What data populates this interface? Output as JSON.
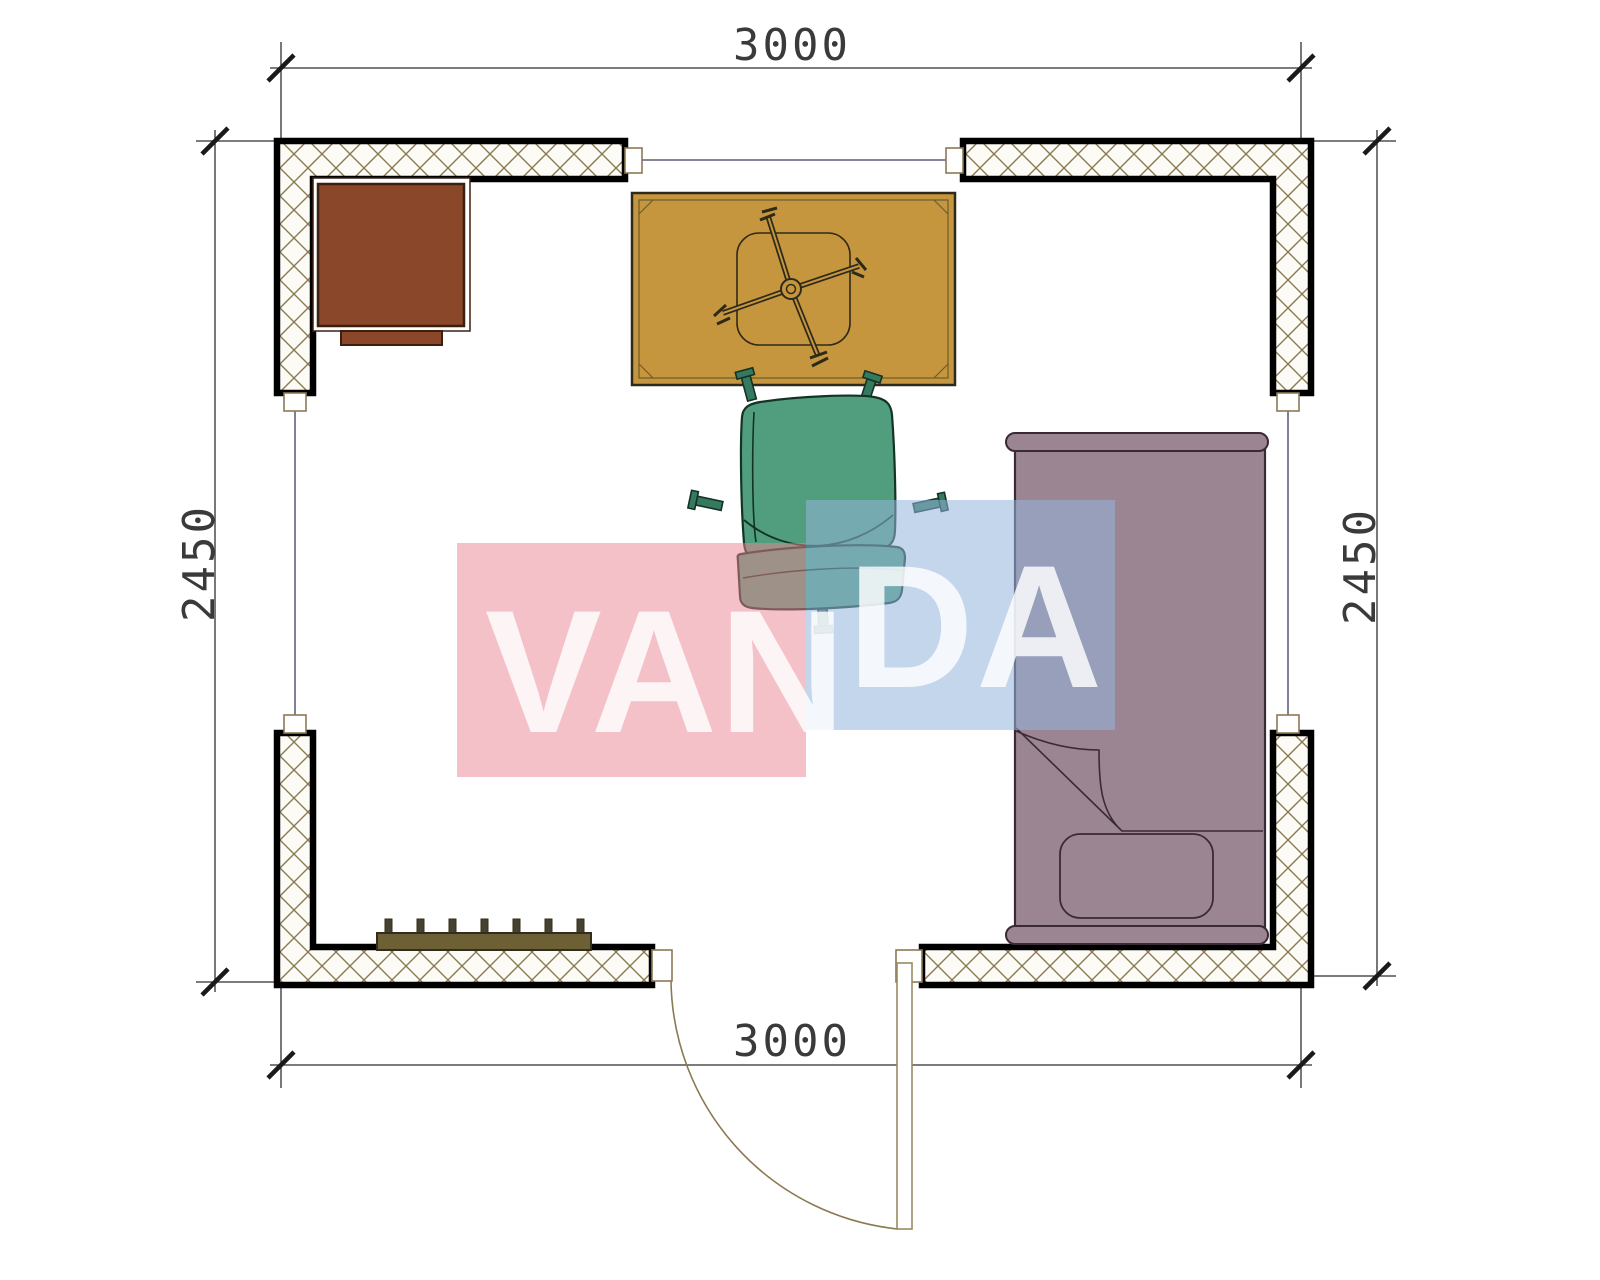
{
  "drawing": {
    "type": "floor-plan",
    "room_width_mm": "3000",
    "room_depth_mm": "2450"
  },
  "dimensions": {
    "top": "3000",
    "bottom": "3000",
    "left": "2450",
    "right": "2450"
  },
  "watermark": {
    "full_text": "VANDA",
    "part1": "VAN",
    "part2": "DA",
    "pink_block": "#f6c2c9",
    "blue_block": "#c9def0",
    "text_color": "#ffffff"
  },
  "furniture": {
    "desk": "corner desk",
    "table": "table with fan",
    "chair": "office chair",
    "bed": "single bed with pillow",
    "radiator": "radiator",
    "door": "swing door"
  },
  "colors": {
    "wall_outline": "#000000",
    "wall_hatch": "#8a7a52",
    "axis_line": "#3c3c64",
    "dimension": "#2f2f2f",
    "desk": "#8a4729",
    "table": "#c6963e",
    "chair": "#509e7d",
    "bed": "#9b8593",
    "radiator": "#6d6034"
  }
}
